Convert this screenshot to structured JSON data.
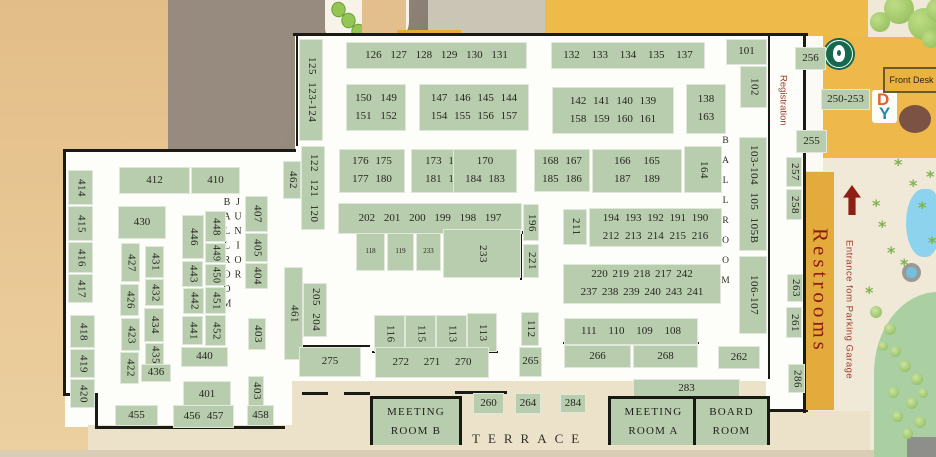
{
  "labels": {
    "junior_ballroom": "JUNIOR BALLROOM",
    "ballroom": "BALLROOM",
    "registration": "Registration",
    "restrooms": "Restrooms",
    "entrance": "Entrance fom Parking Garage",
    "terrace": "TERRACE",
    "front_desk": "Front Desk",
    "logo_d": "D",
    "logo_y": "Y"
  },
  "colors": {
    "booth_green": "#b8cdae",
    "wall_black": "#1b1b16",
    "building_gold": "#eeba4a",
    "restrooms_gold": "#e3aa3c",
    "red_text": "#a33a28",
    "restrooms_text": "#8b1a12",
    "tan": "#e3bd87",
    "street_gray": "#968b7e",
    "floor_white": "#fdfdfa",
    "terrace_cream": "#ece2ca",
    "pond_blue": "#8ed3ee",
    "lawn_green": "#a9cfa2",
    "starbucks_green": "#14694c"
  },
  "rooms": [
    {
      "name": "meeting-room-b",
      "lines": [
        "Meeting",
        "Room B"
      ],
      "x": 370,
      "y": 396,
      "w": 86,
      "h": 46
    },
    {
      "name": "meeting-room-a",
      "lines": [
        "Meeting",
        "Room A"
      ],
      "x": 608,
      "y": 396,
      "w": 85,
      "h": 46
    },
    {
      "name": "board-room",
      "lines": [
        "Board",
        "Room"
      ],
      "x": 693,
      "y": 396,
      "w": 71,
      "h": 46
    }
  ],
  "booths": [
    {
      "t": "125 123-124",
      "x": 299,
      "y": 39,
      "w": 24,
      "h": 102,
      "r": 1
    },
    {
      "t": "126 127 128 129 130 131",
      "x": 346,
      "y": 42,
      "w": 181,
      "h": 27,
      "ws": 6
    },
    {
      "t": "132 133 134 135 137",
      "x": 551,
      "y": 42,
      "w": 154,
      "h": 27,
      "ws": 9
    },
    {
      "t": "101",
      "x": 726,
      "y": 39,
      "w": 41,
      "h": 26
    },
    {
      "t": "102",
      "x": 740,
      "y": 66,
      "w": 27,
      "h": 42,
      "r": 1
    },
    {
      "lines": [
        "150 149",
        "151 152"
      ],
      "x": 346,
      "y": 84,
      "w": 60,
      "h": 47,
      "ws": 6
    },
    {
      "lines": [
        "147 146 145 144",
        "154 155 156 157"
      ],
      "x": 419,
      "y": 84,
      "w": 110,
      "h": 47
    },
    {
      "lines": [
        "142 141 140 139",
        "158 159 160 161"
      ],
      "x": 552,
      "y": 87,
      "w": 122,
      "h": 47
    },
    {
      "lines": [
        "138",
        "163"
      ],
      "x": 686,
      "y": 84,
      "w": 40,
      "h": 50
    },
    {
      "t": "103-104 105 105B",
      "x": 739,
      "y": 137,
      "w": 28,
      "h": 114,
      "r": 1
    },
    {
      "lines": [
        "176 175",
        "177 180"
      ],
      "x": 339,
      "y": 149,
      "w": 66,
      "h": 44
    },
    {
      "lines": [
        "173 172",
        "181 182"
      ],
      "x": 411,
      "y": 149,
      "w": 68,
      "h": 44
    },
    {
      "lines": [
        "170",
        "184 183"
      ],
      "x": 453,
      "y": 149,
      "w": 64,
      "h": 44
    },
    {
      "lines": [
        "168 167",
        "185 186"
      ],
      "x": 534,
      "y": 149,
      "w": 56,
      "h": 43
    },
    {
      "lines": [
        "166 165",
        "187 189"
      ],
      "x": 592,
      "y": 149,
      "w": 90,
      "h": 44,
      "ws": 10
    },
    {
      "t": "164",
      "x": 684,
      "y": 146,
      "w": 38,
      "h": 47,
      "r": 1
    },
    {
      "t": "202 201 200 199 198 197",
      "x": 338,
      "y": 203,
      "w": 184,
      "h": 31,
      "ws": 6
    },
    {
      "t": "196",
      "x": 523,
      "y": 204,
      "w": 16,
      "h": 37,
      "r": 1
    },
    {
      "t": "221",
      "x": 523,
      "y": 244,
      "w": 16,
      "h": 34,
      "r": 1
    },
    {
      "t": "118",
      "x": 356,
      "y": 233,
      "w": 29,
      "h": 38,
      "fs": 7
    },
    {
      "t": "119",
      "x": 387,
      "y": 233,
      "w": 27,
      "h": 38,
      "fs": 7
    },
    {
      "t": "233",
      "x": 416,
      "y": 233,
      "w": 25,
      "h": 38,
      "fs": 7
    },
    {
      "t": "233",
      "x": 443,
      "y": 229,
      "w": 78,
      "h": 49,
      "r": 1
    },
    {
      "t": "211",
      "x": 563,
      "y": 209,
      "w": 24,
      "h": 36,
      "r": 1
    },
    {
      "lines": [
        "194 193 192 191 190",
        "212 213 214 215 216"
      ],
      "x": 589,
      "y": 208,
      "w": 133,
      "h": 39,
      "ws": 3
    },
    {
      "lines": [
        "220 219 218 217 242",
        "237 238 239 240 243 241"
      ],
      "x": 563,
      "y": 264,
      "w": 158,
      "h": 40,
      "ws": 2
    },
    {
      "t": "106-107",
      "x": 739,
      "y": 256,
      "w": 28,
      "h": 78,
      "r": 1
    },
    {
      "t": "462",
      "x": 283,
      "y": 161,
      "w": 18,
      "h": 38,
      "r": 1
    },
    {
      "t": "122 121 120",
      "x": 301,
      "y": 146,
      "w": 24,
      "h": 84,
      "r": 1
    },
    {
      "t": "461",
      "x": 284,
      "y": 267,
      "w": 19,
      "h": 93,
      "r": 1
    },
    {
      "t": "205 204",
      "x": 303,
      "y": 283,
      "w": 24,
      "h": 54,
      "r": 1
    },
    {
      "t": "116",
      "x": 374,
      "y": 315,
      "w": 31,
      "h": 37,
      "r": 1
    },
    {
      "t": "115",
      "x": 405,
      "y": 315,
      "w": 31,
      "h": 37,
      "r": 1
    },
    {
      "t": "113",
      "x": 436,
      "y": 315,
      "w": 31,
      "h": 37,
      "r": 1
    },
    {
      "t": "113",
      "x": 467,
      "y": 313,
      "w": 30,
      "h": 39,
      "r": 1
    },
    {
      "t": "275",
      "x": 299,
      "y": 347,
      "w": 62,
      "h": 30
    },
    {
      "t": "272 271 270",
      "x": 375,
      "y": 347,
      "w": 114,
      "h": 31,
      "ws": 12
    },
    {
      "t": "112",
      "x": 521,
      "y": 312,
      "w": 18,
      "h": 34,
      "r": 1
    },
    {
      "t": "265",
      "x": 519,
      "y": 347,
      "w": 23,
      "h": 30
    },
    {
      "t": "111 110 109 108",
      "x": 564,
      "y": 318,
      "w": 134,
      "h": 27,
      "ws": 9
    },
    {
      "t": "266",
      "x": 564,
      "y": 345,
      "w": 67,
      "h": 23
    },
    {
      "t": "268",
      "x": 633,
      "y": 345,
      "w": 65,
      "h": 23
    },
    {
      "t": "262",
      "x": 718,
      "y": 346,
      "w": 42,
      "h": 23
    },
    {
      "t": "283",
      "x": 633,
      "y": 379,
      "w": 107,
      "h": 19
    },
    {
      "t": "284",
      "x": 560,
      "y": 394,
      "w": 26,
      "h": 19
    },
    {
      "t": "264",
      "x": 515,
      "y": 393,
      "w": 26,
      "h": 21
    },
    {
      "t": "260",
      "x": 473,
      "y": 393,
      "w": 31,
      "h": 21
    },
    {
      "t": "256",
      "x": 795,
      "y": 47,
      "w": 31,
      "h": 23
    },
    {
      "t": "250-253",
      "x": 821,
      "y": 89,
      "w": 49,
      "h": 21
    },
    {
      "t": "255",
      "x": 796,
      "y": 130,
      "w": 31,
      "h": 23
    },
    {
      "t": "257",
      "x": 786,
      "y": 157,
      "w": 16,
      "h": 30,
      "r": 1
    },
    {
      "t": "258",
      "x": 786,
      "y": 189,
      "w": 16,
      "h": 31,
      "r": 1
    },
    {
      "t": "263",
      "x": 787,
      "y": 274,
      "w": 16,
      "h": 28,
      "r": 1
    },
    {
      "t": "261",
      "x": 786,
      "y": 307,
      "w": 16,
      "h": 31,
      "r": 1
    },
    {
      "t": "286",
      "x": 788,
      "y": 364,
      "w": 17,
      "h": 29,
      "r": 1
    },
    {
      "t": "414",
      "x": 68,
      "y": 170,
      "w": 25,
      "h": 35,
      "r": 1
    },
    {
      "t": "415",
      "x": 68,
      "y": 206,
      "w": 25,
      "h": 35,
      "r": 1
    },
    {
      "t": "416",
      "x": 68,
      "y": 242,
      "w": 25,
      "h": 31,
      "r": 1
    },
    {
      "t": "417",
      "x": 68,
      "y": 274,
      "w": 25,
      "h": 29,
      "r": 1
    },
    {
      "t": "418",
      "x": 70,
      "y": 315,
      "w": 25,
      "h": 33,
      "r": 1
    },
    {
      "t": "419",
      "x": 70,
      "y": 349,
      "w": 25,
      "h": 29,
      "r": 1
    },
    {
      "t": "420",
      "x": 70,
      "y": 379,
      "w": 25,
      "h": 29,
      "r": 1
    },
    {
      "t": "412",
      "x": 119,
      "y": 167,
      "w": 71,
      "h": 27
    },
    {
      "t": "410",
      "x": 191,
      "y": 167,
      "w": 49,
      "h": 27
    },
    {
      "t": "430",
      "x": 118,
      "y": 206,
      "w": 48,
      "h": 33
    },
    {
      "t": "427",
      "x": 121,
      "y": 243,
      "w": 19,
      "h": 39,
      "r": 1
    },
    {
      "t": "426",
      "x": 120,
      "y": 284,
      "w": 19,
      "h": 32,
      "r": 1
    },
    {
      "t": "423",
      "x": 121,
      "y": 318,
      "w": 19,
      "h": 33,
      "r": 1
    },
    {
      "t": "422",
      "x": 120,
      "y": 352,
      "w": 19,
      "h": 32,
      "r": 1
    },
    {
      "t": "431",
      "x": 145,
      "y": 246,
      "w": 19,
      "h": 32,
      "r": 1
    },
    {
      "t": "432",
      "x": 145,
      "y": 279,
      "w": 19,
      "h": 27,
      "r": 1
    },
    {
      "t": "434",
      "x": 144,
      "y": 308,
      "w": 20,
      "h": 34,
      "r": 1
    },
    {
      "t": "435",
      "x": 145,
      "y": 343,
      "w": 19,
      "h": 23,
      "r": 1
    },
    {
      "t": "436",
      "x": 141,
      "y": 364,
      "w": 30,
      "h": 18
    },
    {
      "t": "446",
      "x": 182,
      "y": 215,
      "w": 22,
      "h": 44,
      "r": 1
    },
    {
      "t": "443",
      "x": 182,
      "y": 261,
      "w": 21,
      "h": 26,
      "r": 1
    },
    {
      "t": "442",
      "x": 183,
      "y": 288,
      "w": 21,
      "h": 26,
      "r": 1
    },
    {
      "t": "441",
      "x": 182,
      "y": 316,
      "w": 21,
      "h": 29,
      "r": 1
    },
    {
      "t": "448",
      "x": 205,
      "y": 211,
      "w": 21,
      "h": 31,
      "r": 1
    },
    {
      "t": "449",
      "x": 205,
      "y": 243,
      "w": 21,
      "h": 20,
      "r": 1,
      "fs": 10
    },
    {
      "t": "450",
      "x": 205,
      "y": 264,
      "w": 21,
      "h": 22,
      "r": 1,
      "fs": 10
    },
    {
      "t": "451",
      "x": 205,
      "y": 287,
      "w": 21,
      "h": 27,
      "r": 1
    },
    {
      "t": "452",
      "x": 205,
      "y": 315,
      "w": 21,
      "h": 31,
      "r": 1
    },
    {
      "t": "440",
      "x": 181,
      "y": 347,
      "w": 47,
      "h": 20
    },
    {
      "t": "401",
      "x": 183,
      "y": 381,
      "w": 48,
      "h": 27
    },
    {
      "t": "455",
      "x": 115,
      "y": 405,
      "w": 43,
      "h": 21
    },
    {
      "t": "456 457",
      "x": 173,
      "y": 405,
      "w": 61,
      "h": 23
    },
    {
      "t": "458",
      "x": 247,
      "y": 405,
      "w": 27,
      "h": 21
    },
    {
      "t": "407",
      "x": 245,
      "y": 196,
      "w": 23,
      "h": 36,
      "r": 1
    },
    {
      "t": "405",
      "x": 245,
      "y": 233,
      "w": 23,
      "h": 29,
      "r": 1
    },
    {
      "t": "404",
      "x": 245,
      "y": 263,
      "w": 23,
      "h": 26,
      "r": 1
    },
    {
      "t": "403",
      "x": 248,
      "y": 318,
      "w": 18,
      "h": 32,
      "r": 1
    },
    {
      "t": "403",
      "x": 248,
      "y": 376,
      "w": 16,
      "h": 30,
      "r": 1
    }
  ]
}
